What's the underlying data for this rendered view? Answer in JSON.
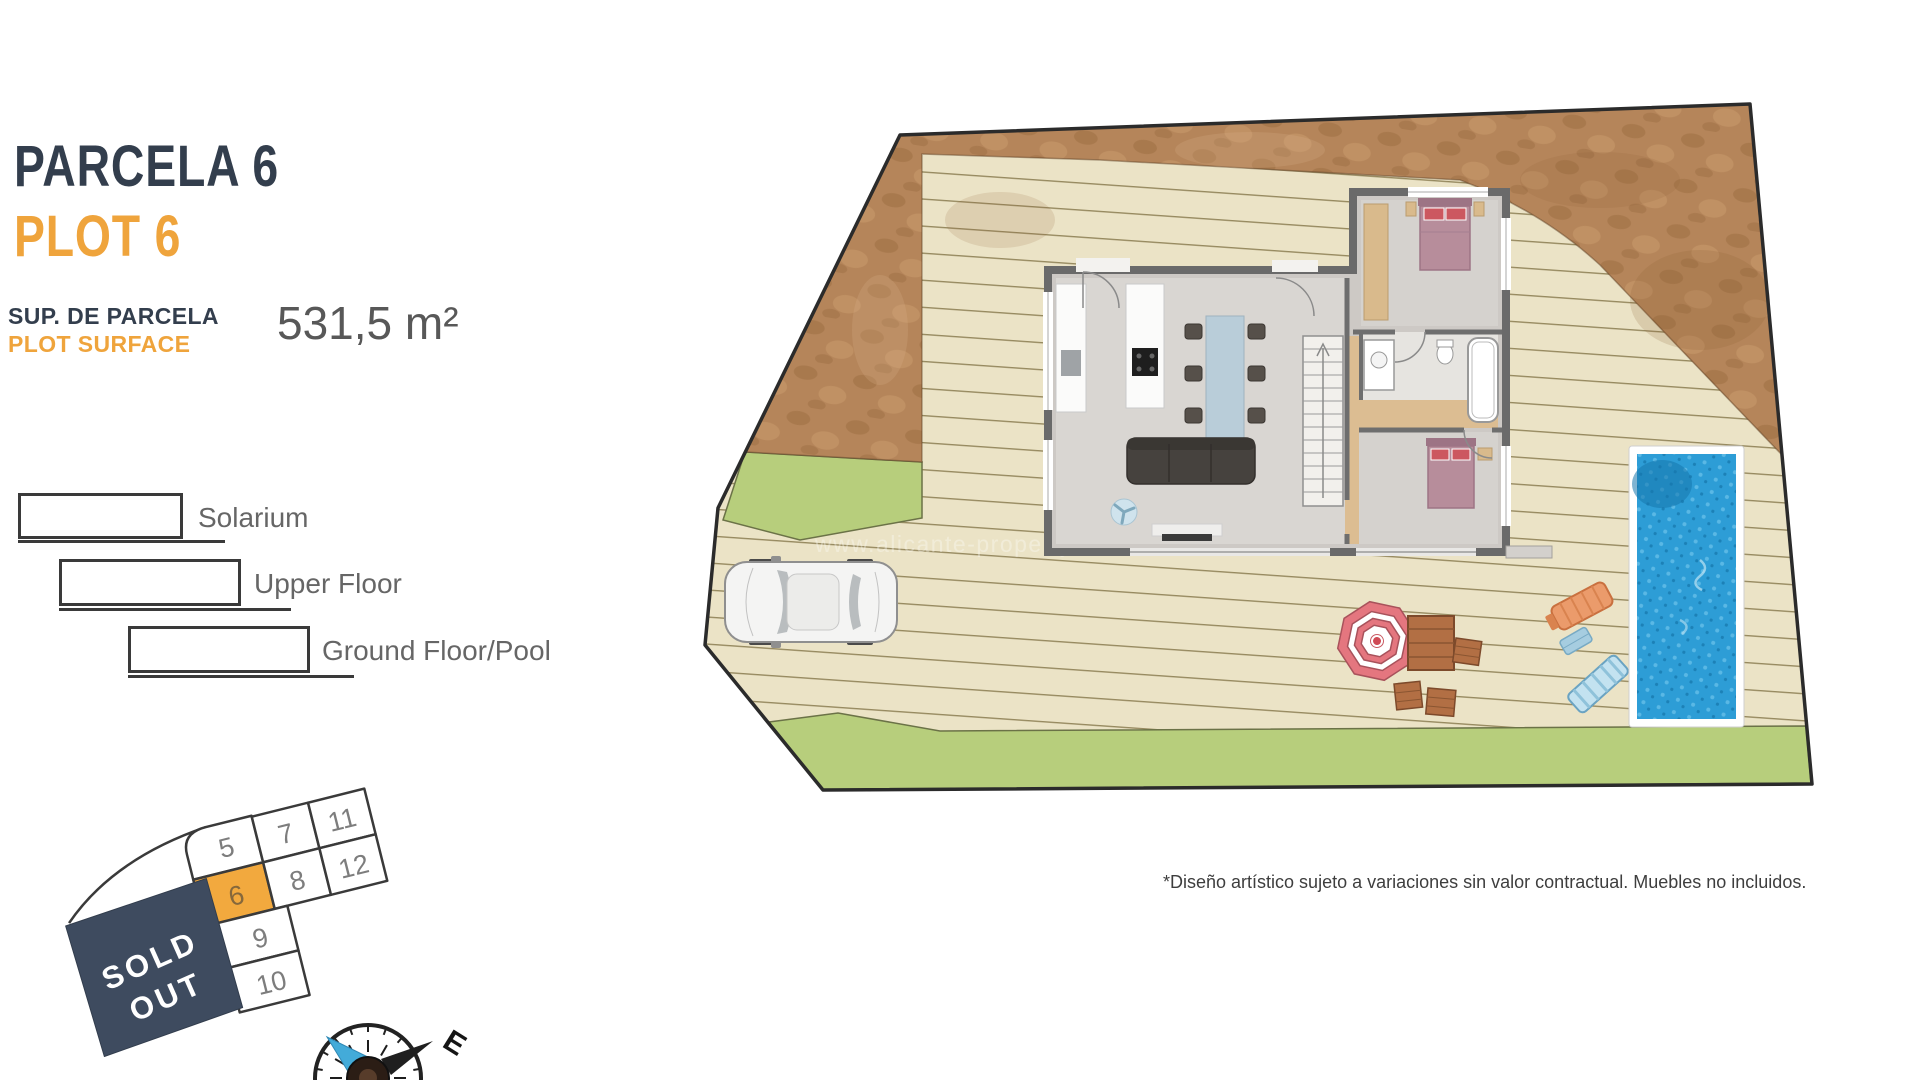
{
  "header": {
    "title_es": "PARCELA 6",
    "title_en": "PLOT 6",
    "surface_label_es": "SUP. DE PARCELA",
    "surface_label_en": "PLOT SURFACE",
    "surface_value": "531,5 m²"
  },
  "legend": {
    "items": [
      {
        "label": "Solarium"
      },
      {
        "label": "Upper Floor"
      },
      {
        "label": "Ground Floor/Pool"
      }
    ]
  },
  "minimap": {
    "plots": {
      "p5": "5",
      "p6": "6",
      "p7": "7",
      "p8": "8",
      "p9": "9",
      "p10": "10",
      "p11": "11",
      "p12": "12"
    },
    "highlighted_plot": "6",
    "sold_out_lines": [
      "SOLD",
      "OUT"
    ]
  },
  "compass": {
    "east": "E"
  },
  "siteplan": {
    "watermark": "www.alicante-property.no"
  },
  "footer": {
    "disclaimer": "*Diseño artístico sujeto a variaciones sin valor contractual. Muebles no incluidos."
  },
  "colors": {
    "navy": "#333e4d",
    "orange": "#efa43c",
    "deck": "#ebe3c6",
    "dirt": "#b5855a",
    "grass": "#b7ce7c",
    "pool_water": "#2d9dd6",
    "sold_out_bg": "#3e4b5f",
    "plot_highlight": "#f2a93e"
  }
}
